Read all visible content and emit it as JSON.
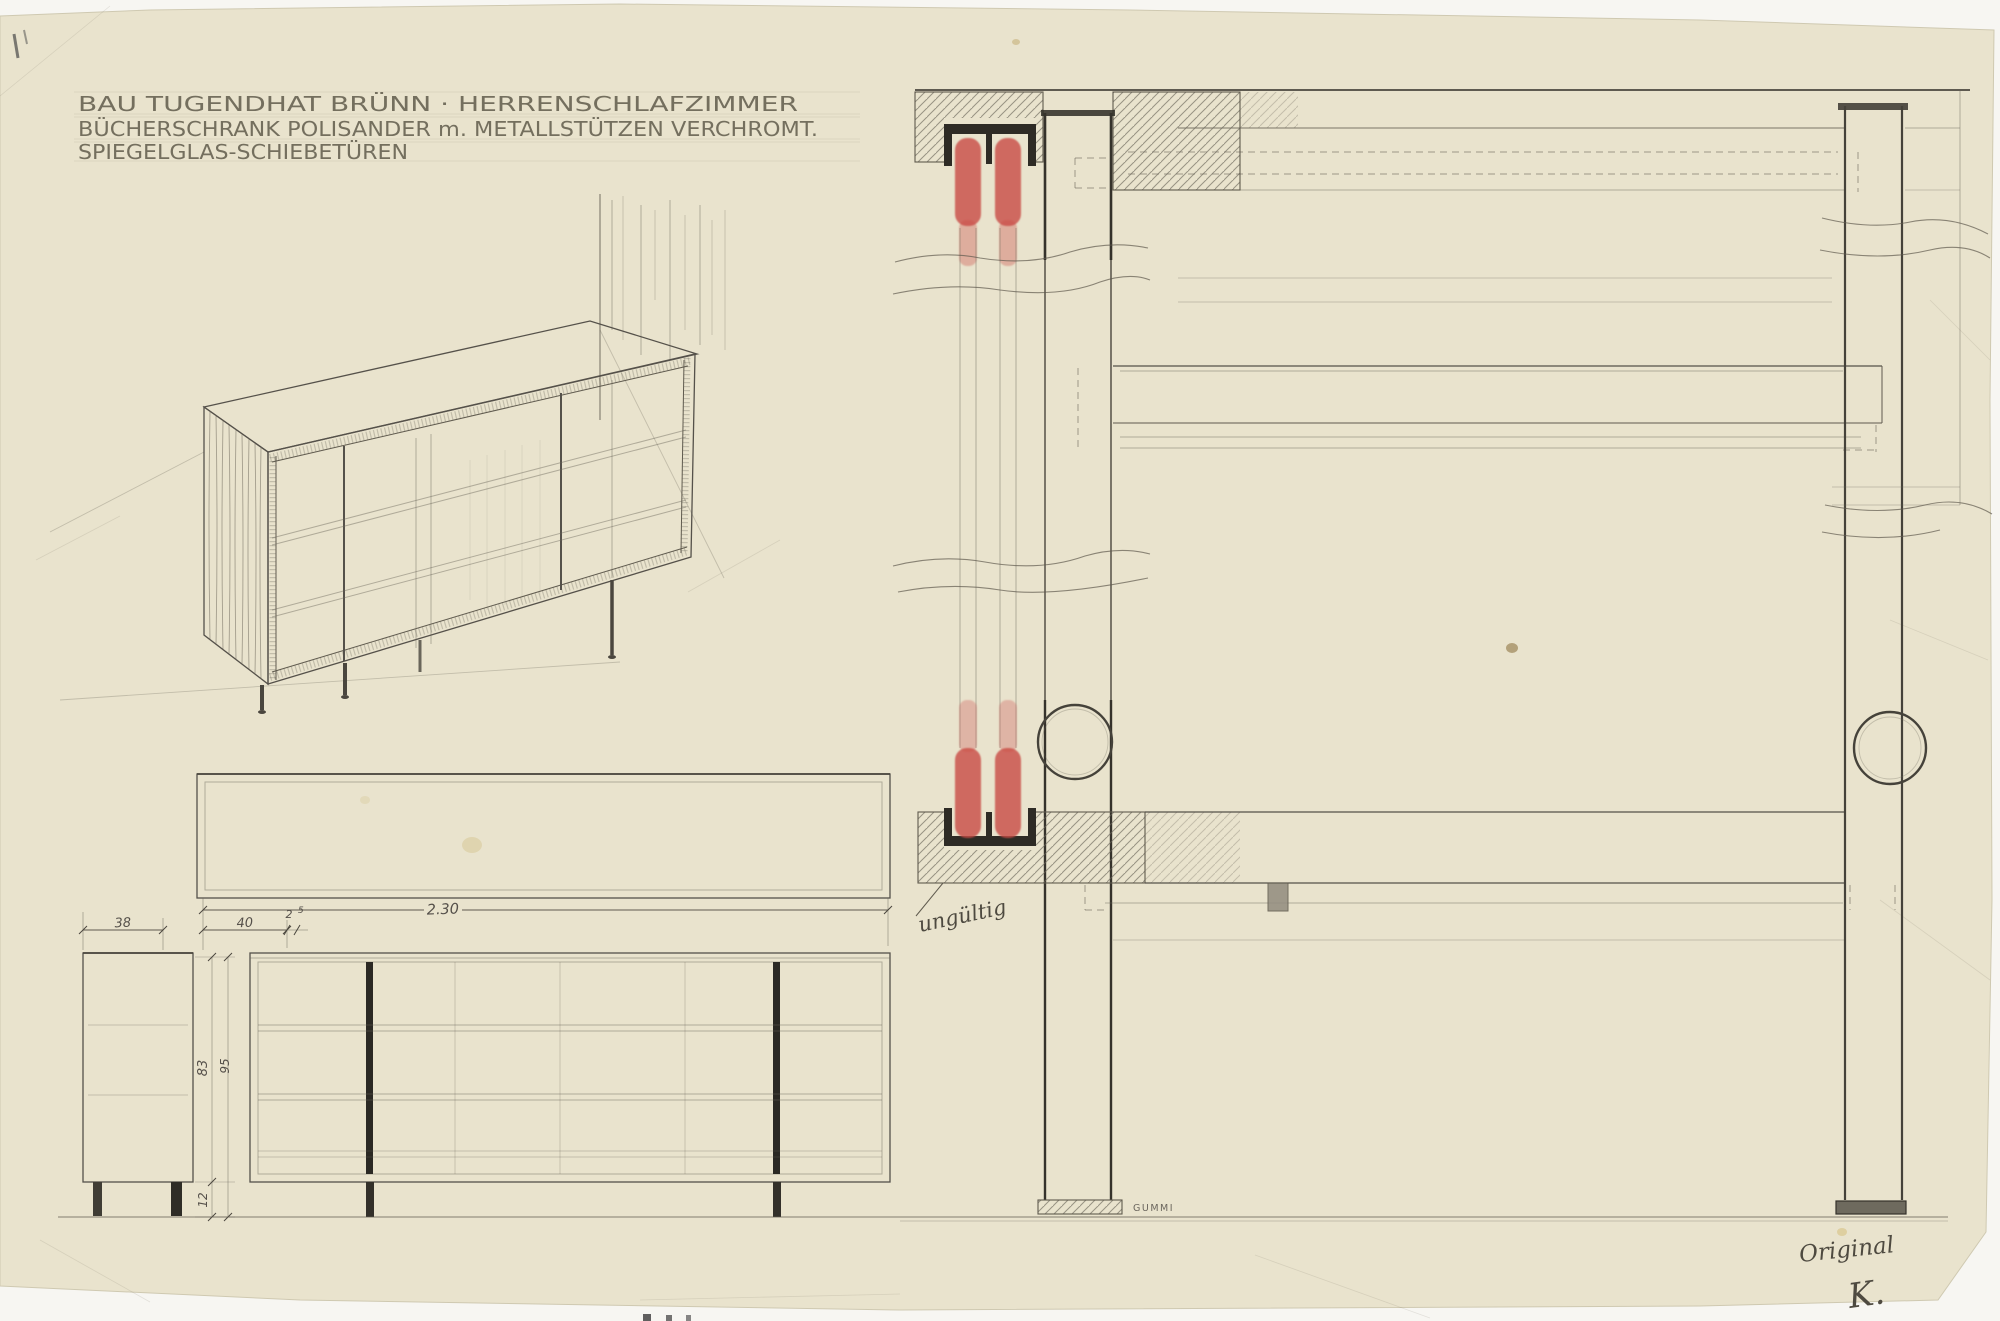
{
  "sheet": {
    "title_lines": [
      "BAU TUGENDHAT BRÜNN · HERRENSCHLAFZIMMER",
      "BÜCHERSCHRANK POLISANDER m. METALLSTÜTZEN VERCHROMT.",
      "SPIEGELGLAS-SCHIEBETÜREN"
    ]
  },
  "dimensions": {
    "overall_length": "2.30",
    "depth": "38",
    "left_bay_width": "40",
    "small_gap_main": "2",
    "small_gap_sup": "5",
    "body_height": "83",
    "overall_height": "95",
    "leg_height": "12"
  },
  "annotations": {
    "invalid_note": "ungültig",
    "rubber_label": "GUMMI",
    "original_label": "Original",
    "signature": "K."
  },
  "colors": {
    "paper": "#e9e3cd",
    "pencil": "#5f5a4e",
    "pencil_dark": "#35322b",
    "red_crayon": "#c94a44",
    "scan_background": "#f7f6f2"
  }
}
